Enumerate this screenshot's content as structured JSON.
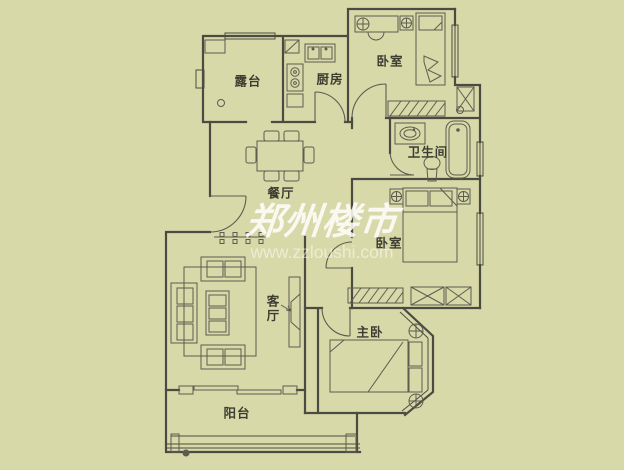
{
  "title": "apartment-floor-plan",
  "colors": {
    "background": "#d8d9a9",
    "wall": "#4b4c41",
    "furniture": "#5c5d4f",
    "label": "#3c3d31",
    "watermark": "#ffffff"
  },
  "rooms": [
    {
      "id": "terrace",
      "label": "露台"
    },
    {
      "id": "kitchen",
      "label": "厨房"
    },
    {
      "id": "bedroom-north",
      "label": "卧室"
    },
    {
      "id": "bathroom",
      "label": "卫生间"
    },
    {
      "id": "dining-room",
      "label": "餐厅"
    },
    {
      "id": "bedroom-east",
      "label": "卧室"
    },
    {
      "id": "living-room",
      "label": "客厅"
    },
    {
      "id": "master-bedroom",
      "label": "主卧"
    },
    {
      "id": "balcony",
      "label": "阳台"
    }
  ],
  "watermark": {
    "brand": "郑州楼市",
    "url": "www.zzloushi.com"
  },
  "fixtures": [
    "kitchen-sink",
    "stove",
    "fridge",
    "dining-table",
    "dining-chairs",
    "sofa-set",
    "coffee-table",
    "tv-cabinet",
    "tv",
    "rug",
    "bed",
    "pillows",
    "nightstand-lamp",
    "wardrobe",
    "closet",
    "washbasin",
    "toilet",
    "bathtub",
    "desk",
    "desk-chair",
    "bay-window",
    "sliding-door",
    "door-arc",
    "window",
    "duct",
    "floor-drain",
    "bead-screen"
  ]
}
